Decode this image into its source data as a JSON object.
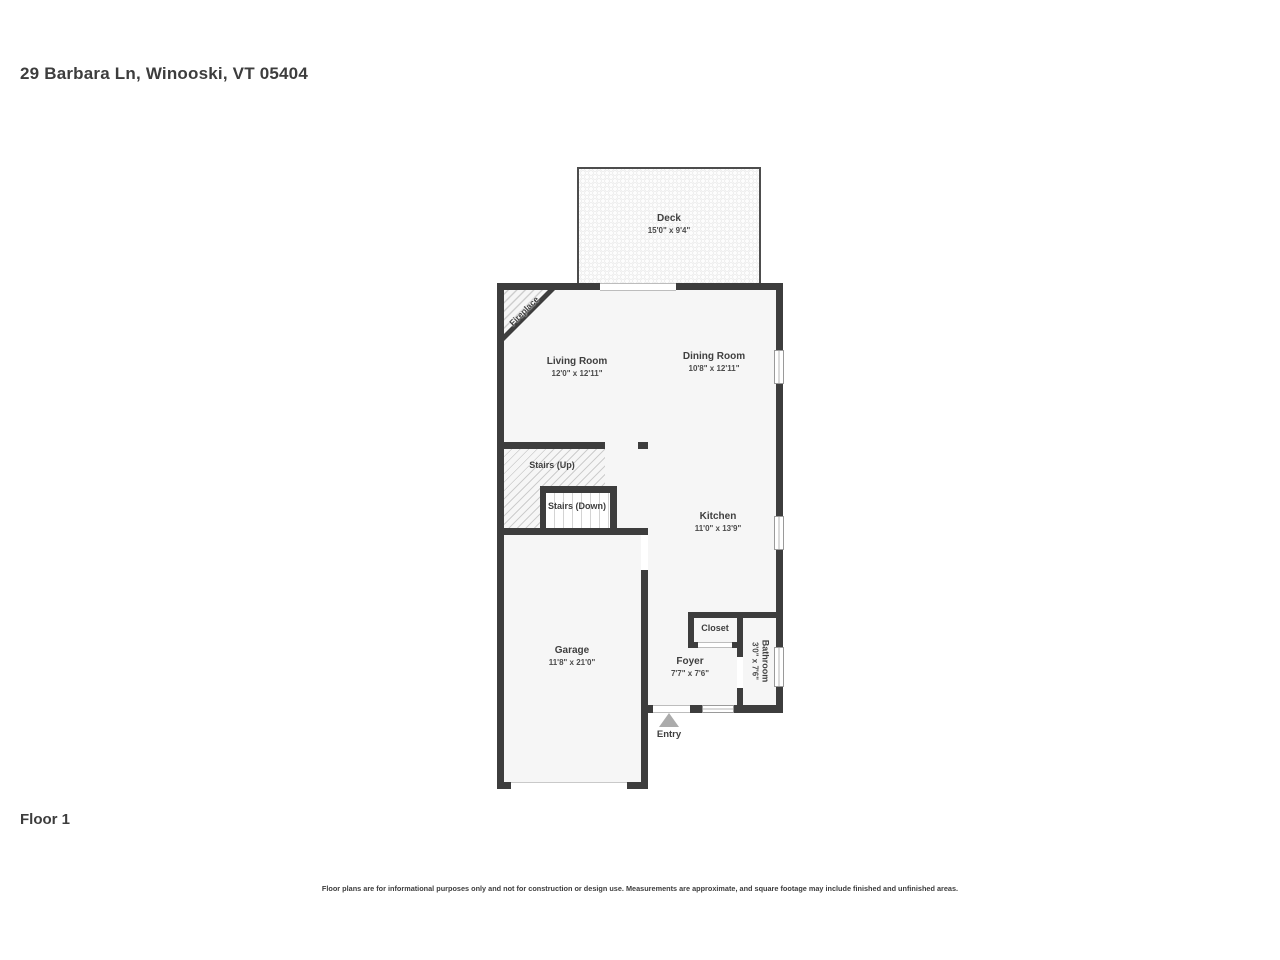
{
  "title": "29 Barbara Ln, Winooski, VT 05404",
  "floor": {
    "label": "Floor 1"
  },
  "disclaimer": "Floor plans are for informational purposes only and not for construction or design use. Measurements are approximate, and square footage may include finished and unfinished areas.",
  "colors": {
    "wall": "#3d3d3d",
    "floor_fill": "#f6f6f6",
    "text": "#3f3f3f",
    "entry_arrow": "#ababab"
  },
  "rooms": {
    "deck": {
      "name": "Deck",
      "dims": "15'0\" x 9'4\""
    },
    "living_room": {
      "name": "Living Room",
      "dims": "12'0\" x 12'11\""
    },
    "dining_room": {
      "name": "Dining Room",
      "dims": "10'8\" x 12'11\""
    },
    "stairs_up": {
      "name": "Stairs (Up)"
    },
    "stairs_down": {
      "name": "Stairs (Down)"
    },
    "kitchen": {
      "name": "Kitchen",
      "dims": "11'0\" x 13'9\""
    },
    "garage": {
      "name": "Garage",
      "dims": "11'8\" x 21'0\""
    },
    "closet": {
      "name": "Closet"
    },
    "foyer": {
      "name": "Foyer",
      "dims": "7'7\" x 7'6\""
    },
    "bathroom": {
      "name": "Bathroom",
      "dims": "3'0\" x 7'6\""
    },
    "fireplace": {
      "name": "Fireplace"
    },
    "entry": {
      "name": "Entry"
    }
  }
}
